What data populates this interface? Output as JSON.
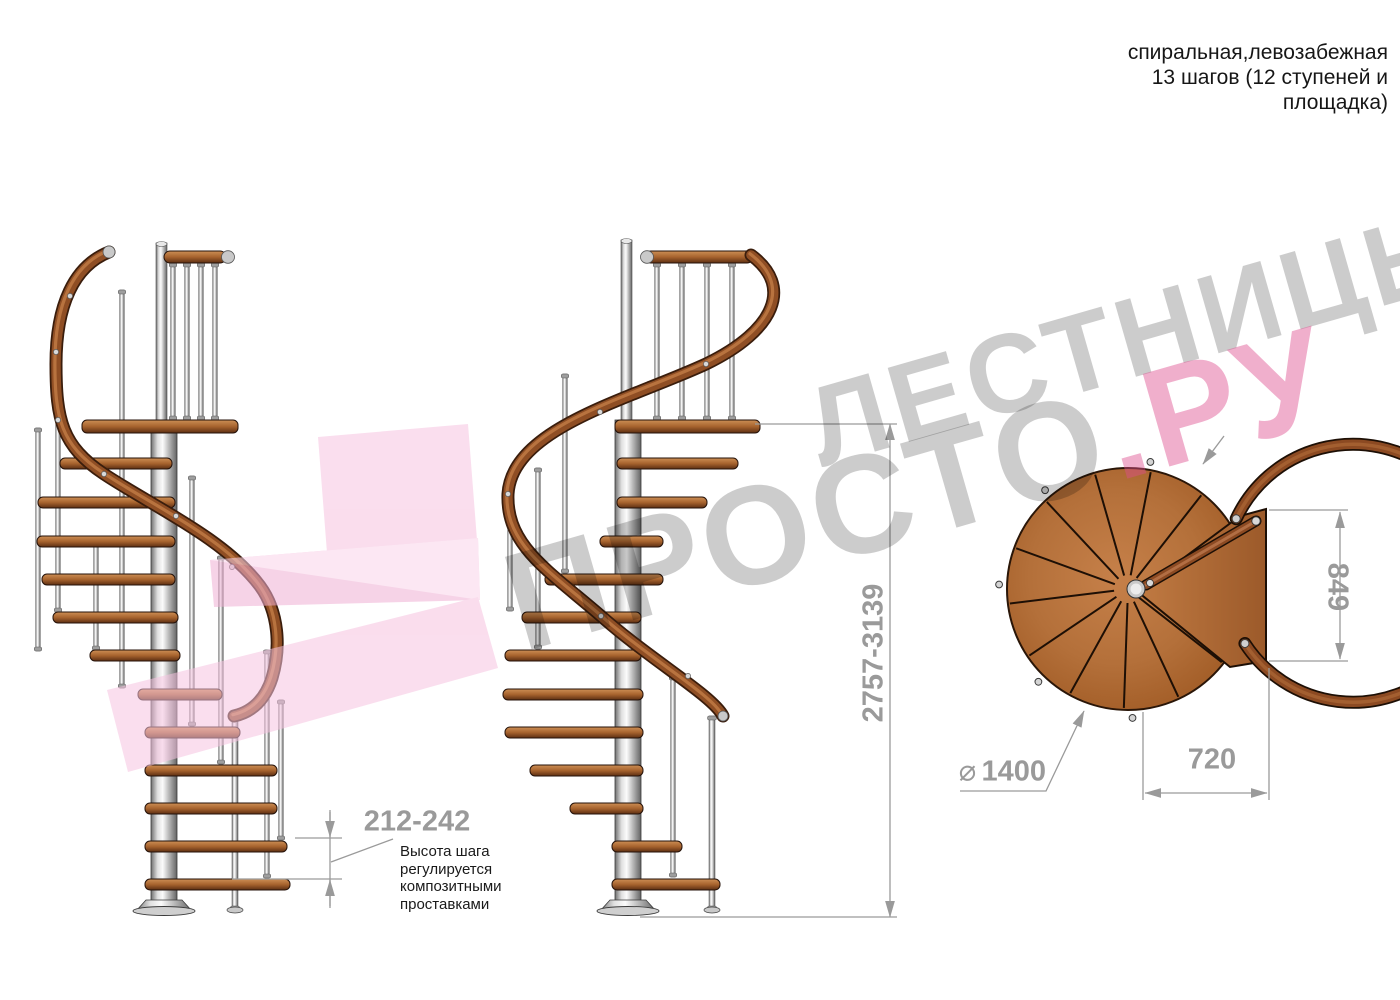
{
  "header": {
    "lines": [
      "спиральная,левозабежная",
      "13 шагов (12 ступеней и",
      "площадка)"
    ]
  },
  "watermark": {
    "line1": "ЛЕСТНИЦЫ",
    "line2_gray": "ПРОСТО",
    "line2_pink": ".РУ"
  },
  "dimensions": {
    "total_height": "2757-3139",
    "step_height": "212-242",
    "diameter_symbol": "⌀",
    "diameter_value": "1400",
    "landing_width": "720",
    "landing_depth": "849"
  },
  "note": {
    "lines": [
      "Высота шага",
      "регулируется",
      "композитными",
      "проставками"
    ]
  },
  "colors": {
    "wood": "#b4703a",
    "handrail": "#8f4e24",
    "metal": "#d9d9d9",
    "watermark_pink": "#f2a9cf",
    "dimension_gray": "#9a9a9a"
  }
}
